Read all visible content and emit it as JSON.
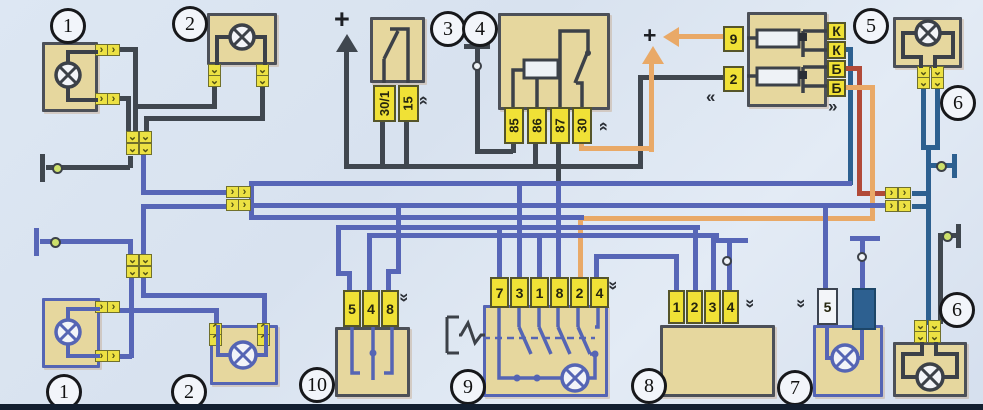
{
  "badges": {
    "b1_top": "1",
    "b2_top": "2",
    "b3": "3",
    "b4": "4",
    "b5": "5",
    "b6_top": "6",
    "b1_bottom": "1",
    "b2_bottom": "2",
    "b10": "10",
    "b9": "9",
    "b8": "8",
    "b7": "7",
    "b6_bottom": "6"
  },
  "plus_signs": {
    "ignition_feed": "+",
    "fuse_feed": "+"
  },
  "ignition_switch": {
    "terminals": [
      "30/1",
      "15"
    ]
  },
  "relay": {
    "terminals": [
      "85",
      "86",
      "87",
      "30"
    ]
  },
  "fuse_box": {
    "inputs": [
      "9",
      "2"
    ],
    "outputs": [
      "К",
      "К",
      "Б",
      "Б"
    ]
  },
  "rheostat": {
    "terminals": [
      "5",
      "4",
      "8"
    ]
  },
  "light_switch": {
    "terminals": [
      "7",
      "3",
      "1",
      "8",
      "2",
      "4"
    ]
  },
  "instrument_cluster": {
    "terminals": [
      "1",
      "2",
      "3",
      "4"
    ]
  },
  "license_plate_lamp": {
    "terminals": [
      "5"
    ]
  },
  "icons": {
    "lamp": "lamp-icon",
    "ground": "ground-icon",
    "connector": "plug-connector-icon",
    "harness_arrow": "double-chevron-icon",
    "plus_arrow": "power-arrow-icon"
  },
  "colors": {
    "background": "#dde7f3",
    "component_fill": "#e6d79e",
    "terminal_yellow": "#f0e136",
    "wire_blue": "#5766b7",
    "wire_dark": "#40474f",
    "wire_steel": "#2d6090",
    "wire_orange": "#e9a967",
    "wire_red": "#b14a38",
    "ground_dot_green": "#cde06b"
  }
}
